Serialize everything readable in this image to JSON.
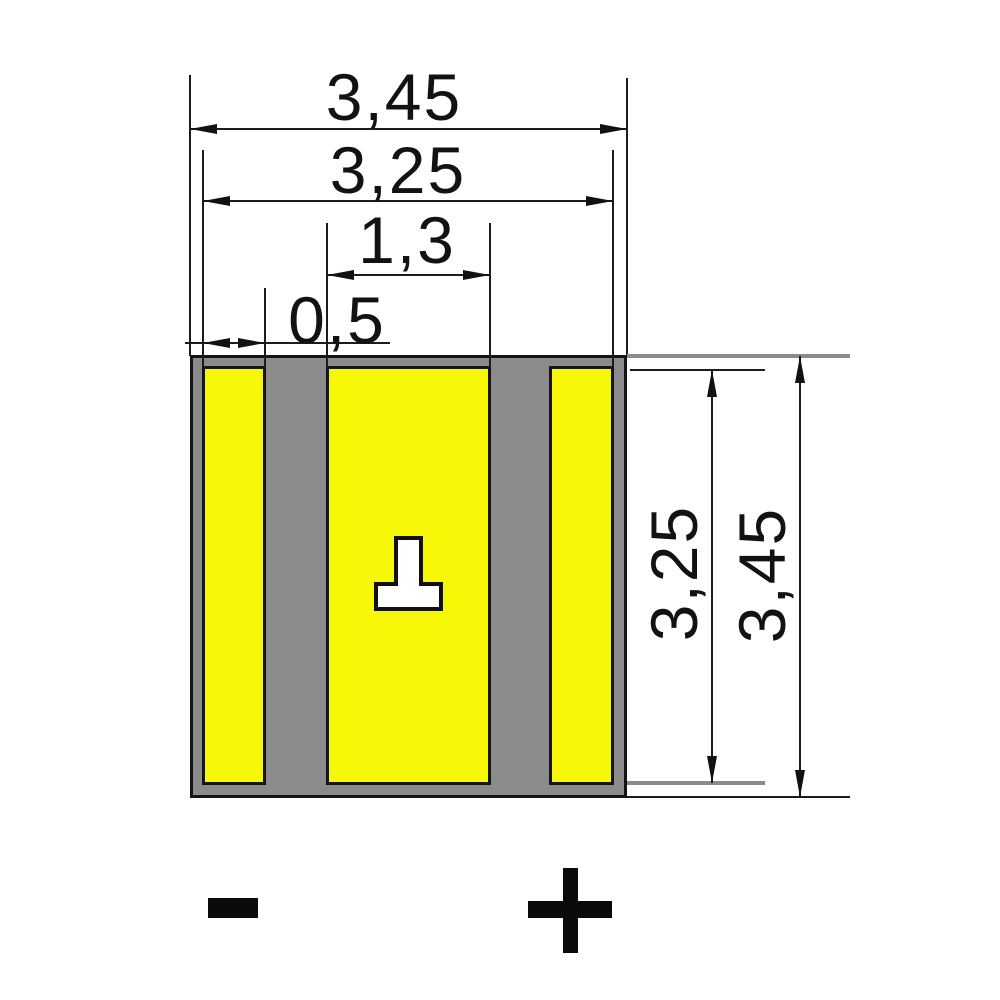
{
  "drawing": {
    "kind": "smd-package-dimension-drawing",
    "dimension_labels": {
      "overall_width": "3,45",
      "pad_span_width": "3,25",
      "center_pad_width": "1,3",
      "side_pad_width": "0,5",
      "pad_height": "3,25",
      "overall_height": "3,45"
    },
    "polarity": {
      "negative": "-",
      "positive": "+"
    },
    "colors": {
      "pad": "#f7f708",
      "body": "#8b8b8b",
      "outline": "#141414",
      "mark_fill": "#ffffff"
    }
  }
}
